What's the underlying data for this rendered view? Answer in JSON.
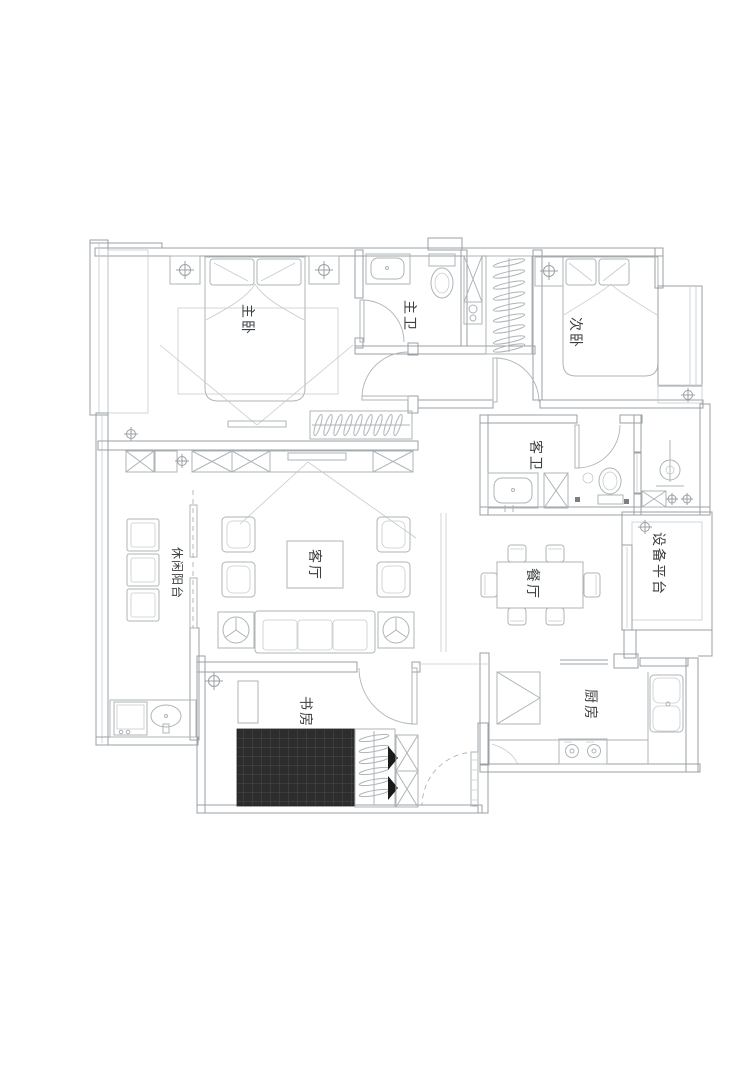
{
  "colors": {
    "background": "#ffffff",
    "wall_line": "#9aa0a4",
    "furniture_line": "#aeb4b7",
    "tatami_fill": "#2d2d2d",
    "label_text": "#3c4043"
  },
  "rooms": [
    {
      "id": "master-bedroom",
      "label": "主卧"
    },
    {
      "id": "master-bath",
      "label": "主卫"
    },
    {
      "id": "second-bedroom",
      "label": "次卧"
    },
    {
      "id": "guest-bath",
      "label": "客卫"
    },
    {
      "id": "living-room",
      "label": "客厅"
    },
    {
      "id": "dining-room",
      "label": "餐厅"
    },
    {
      "id": "leisure-balcony",
      "label": "休闲阳台"
    },
    {
      "id": "study",
      "label": "书房"
    },
    {
      "id": "kitchen",
      "label": "厨房"
    },
    {
      "id": "equipment-platform",
      "label": "设备平台"
    }
  ]
}
